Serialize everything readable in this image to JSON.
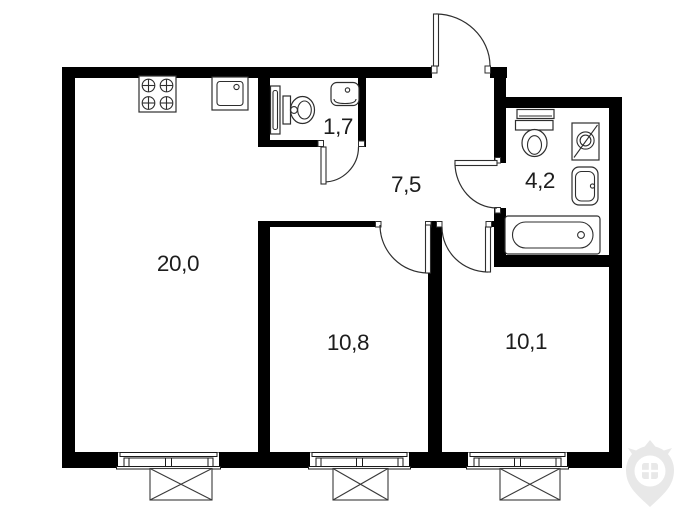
{
  "floor_plan": {
    "background_color": "#ffffff",
    "wall_color": "#000000",
    "fixture_line_color": "#2e2e2e",
    "label_color": "#1d1d1d",
    "watermark_color": "#e8e8e8",
    "rooms": [
      {
        "name": "kitchen-living-room",
        "area_label": "20,0"
      },
      {
        "name": "toilet-wc",
        "area_label": "1,7"
      },
      {
        "name": "hallway",
        "area_label": "7,5"
      },
      {
        "name": "bathroom",
        "area_label": "4,2"
      },
      {
        "name": "bedroom-left",
        "area_label": "10,8"
      },
      {
        "name": "bedroom-right",
        "area_label": "10,1"
      }
    ],
    "icons": [
      "stove-icon",
      "kitchen-sink-icon",
      "water-heater-icon",
      "wc-toilet-icon",
      "wc-sink-icon",
      "entrance-door-icon",
      "door-swing-icon",
      "bath-shelf-icon",
      "bath-toilet-icon",
      "washing-machine-icon",
      "bath-sink-icon",
      "bathtub-icon",
      "window-icon",
      "vent-box-icon",
      "brand-pin-logo-icon"
    ]
  }
}
